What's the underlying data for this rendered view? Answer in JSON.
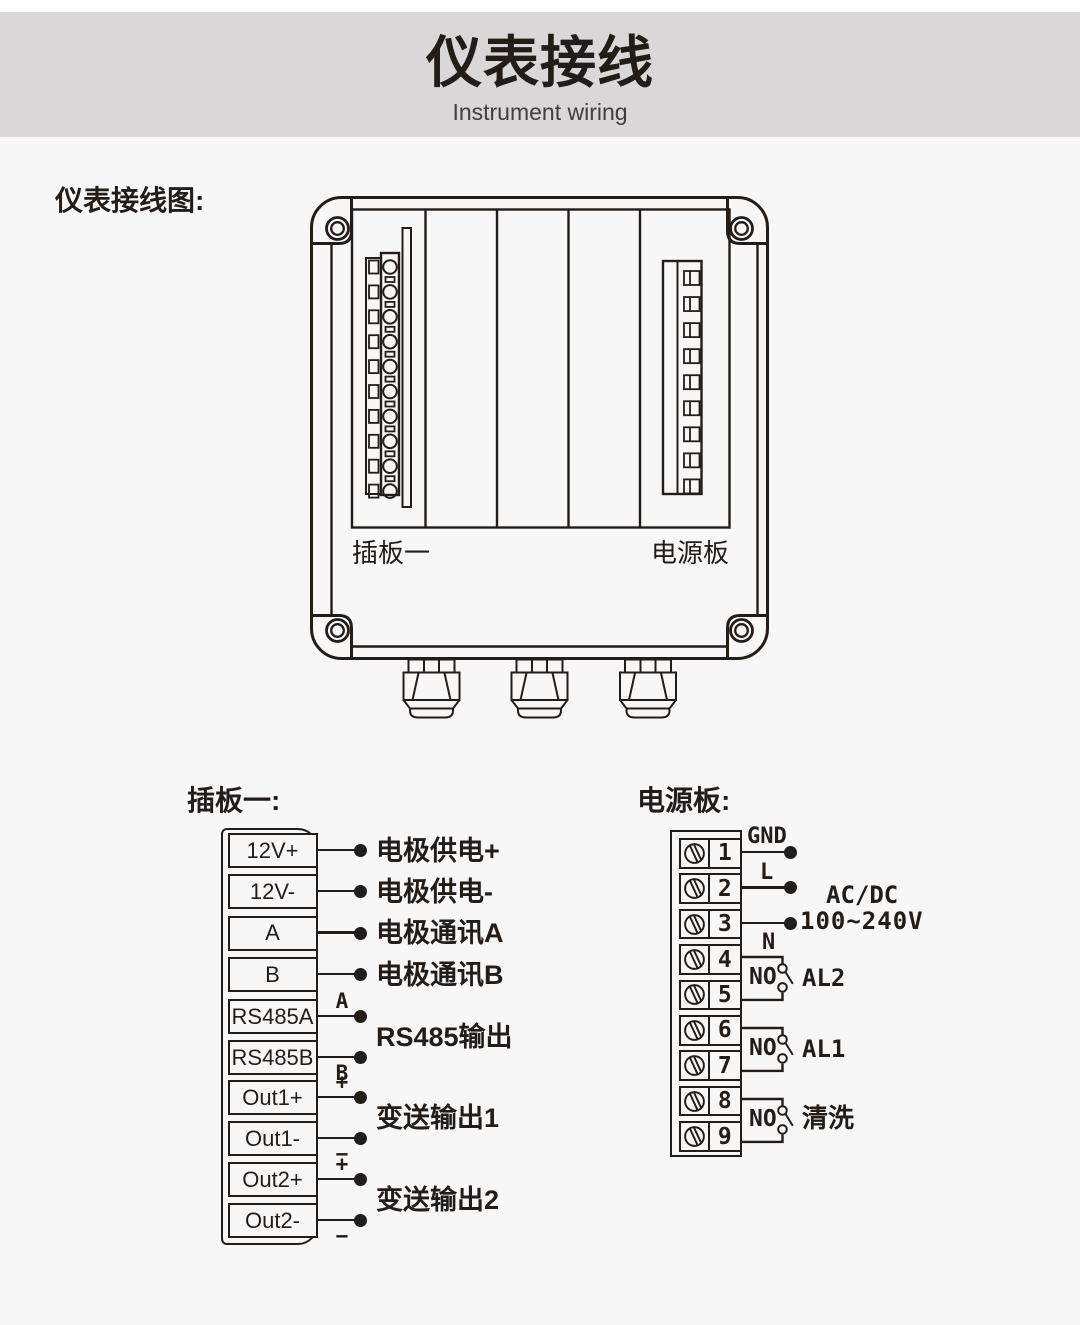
{
  "colors": {
    "ink": "#231d1a",
    "background": "#f7f7f8",
    "header_band": "#d9d7d7",
    "subtitle_text": "#3f3e3e"
  },
  "header": {
    "title": "仪表接线",
    "subtitle": "Instrument wiring"
  },
  "page": {
    "section_label": "仪表接线图:"
  },
  "enclosure": {
    "board1_label": "插板一",
    "power_label": "电源板"
  },
  "plugboard": {
    "title": "插板一:",
    "terminals": [
      "12V+",
      "12V-",
      "A",
      "B",
      "RS485A",
      "RS485B",
      "Out1+",
      "Out1-",
      "Out2+",
      "Out2-"
    ],
    "connections": [
      {
        "type": "single",
        "terminal": 0,
        "label": "电极供电+"
      },
      {
        "type": "single",
        "terminal": 1,
        "label": "电极供电-"
      },
      {
        "type": "single",
        "terminal": 2,
        "label": "电极通讯A"
      },
      {
        "type": "single",
        "terminal": 3,
        "label": "电极通讯B"
      },
      {
        "type": "pair",
        "terminals": [
          4,
          5
        ],
        "marks": [
          "A",
          "B"
        ],
        "label": "RS485输出"
      },
      {
        "type": "pair",
        "terminals": [
          6,
          7
        ],
        "marks": [
          "+",
          "−"
        ],
        "label": "变送输出1"
      },
      {
        "type": "pair",
        "terminals": [
          8,
          9
        ],
        "marks": [
          "+",
          "−"
        ],
        "label": "变送输出2"
      }
    ]
  },
  "powerboard": {
    "title": "电源板:",
    "terminals": [
      "1",
      "2",
      "3",
      "4",
      "5",
      "6",
      "7",
      "8",
      "9"
    ],
    "wires": [
      {
        "terminal": 0,
        "label": "GND",
        "position": "above"
      },
      {
        "terminal": 1,
        "label": "L",
        "position": "above"
      },
      {
        "terminal": 2,
        "label": "N",
        "position": "below"
      }
    ],
    "supply": {
      "line1": "AC/DC",
      "line2": "100~240V"
    },
    "relays": [
      {
        "terminals": [
          3,
          4
        ],
        "contact_label": "NO",
        "name": "AL2"
      },
      {
        "terminals": [
          5,
          6
        ],
        "contact_label": "NO",
        "name": "AL1"
      },
      {
        "terminals": [
          7,
          8
        ],
        "contact_label": "NO",
        "name": "清洗"
      }
    ]
  }
}
